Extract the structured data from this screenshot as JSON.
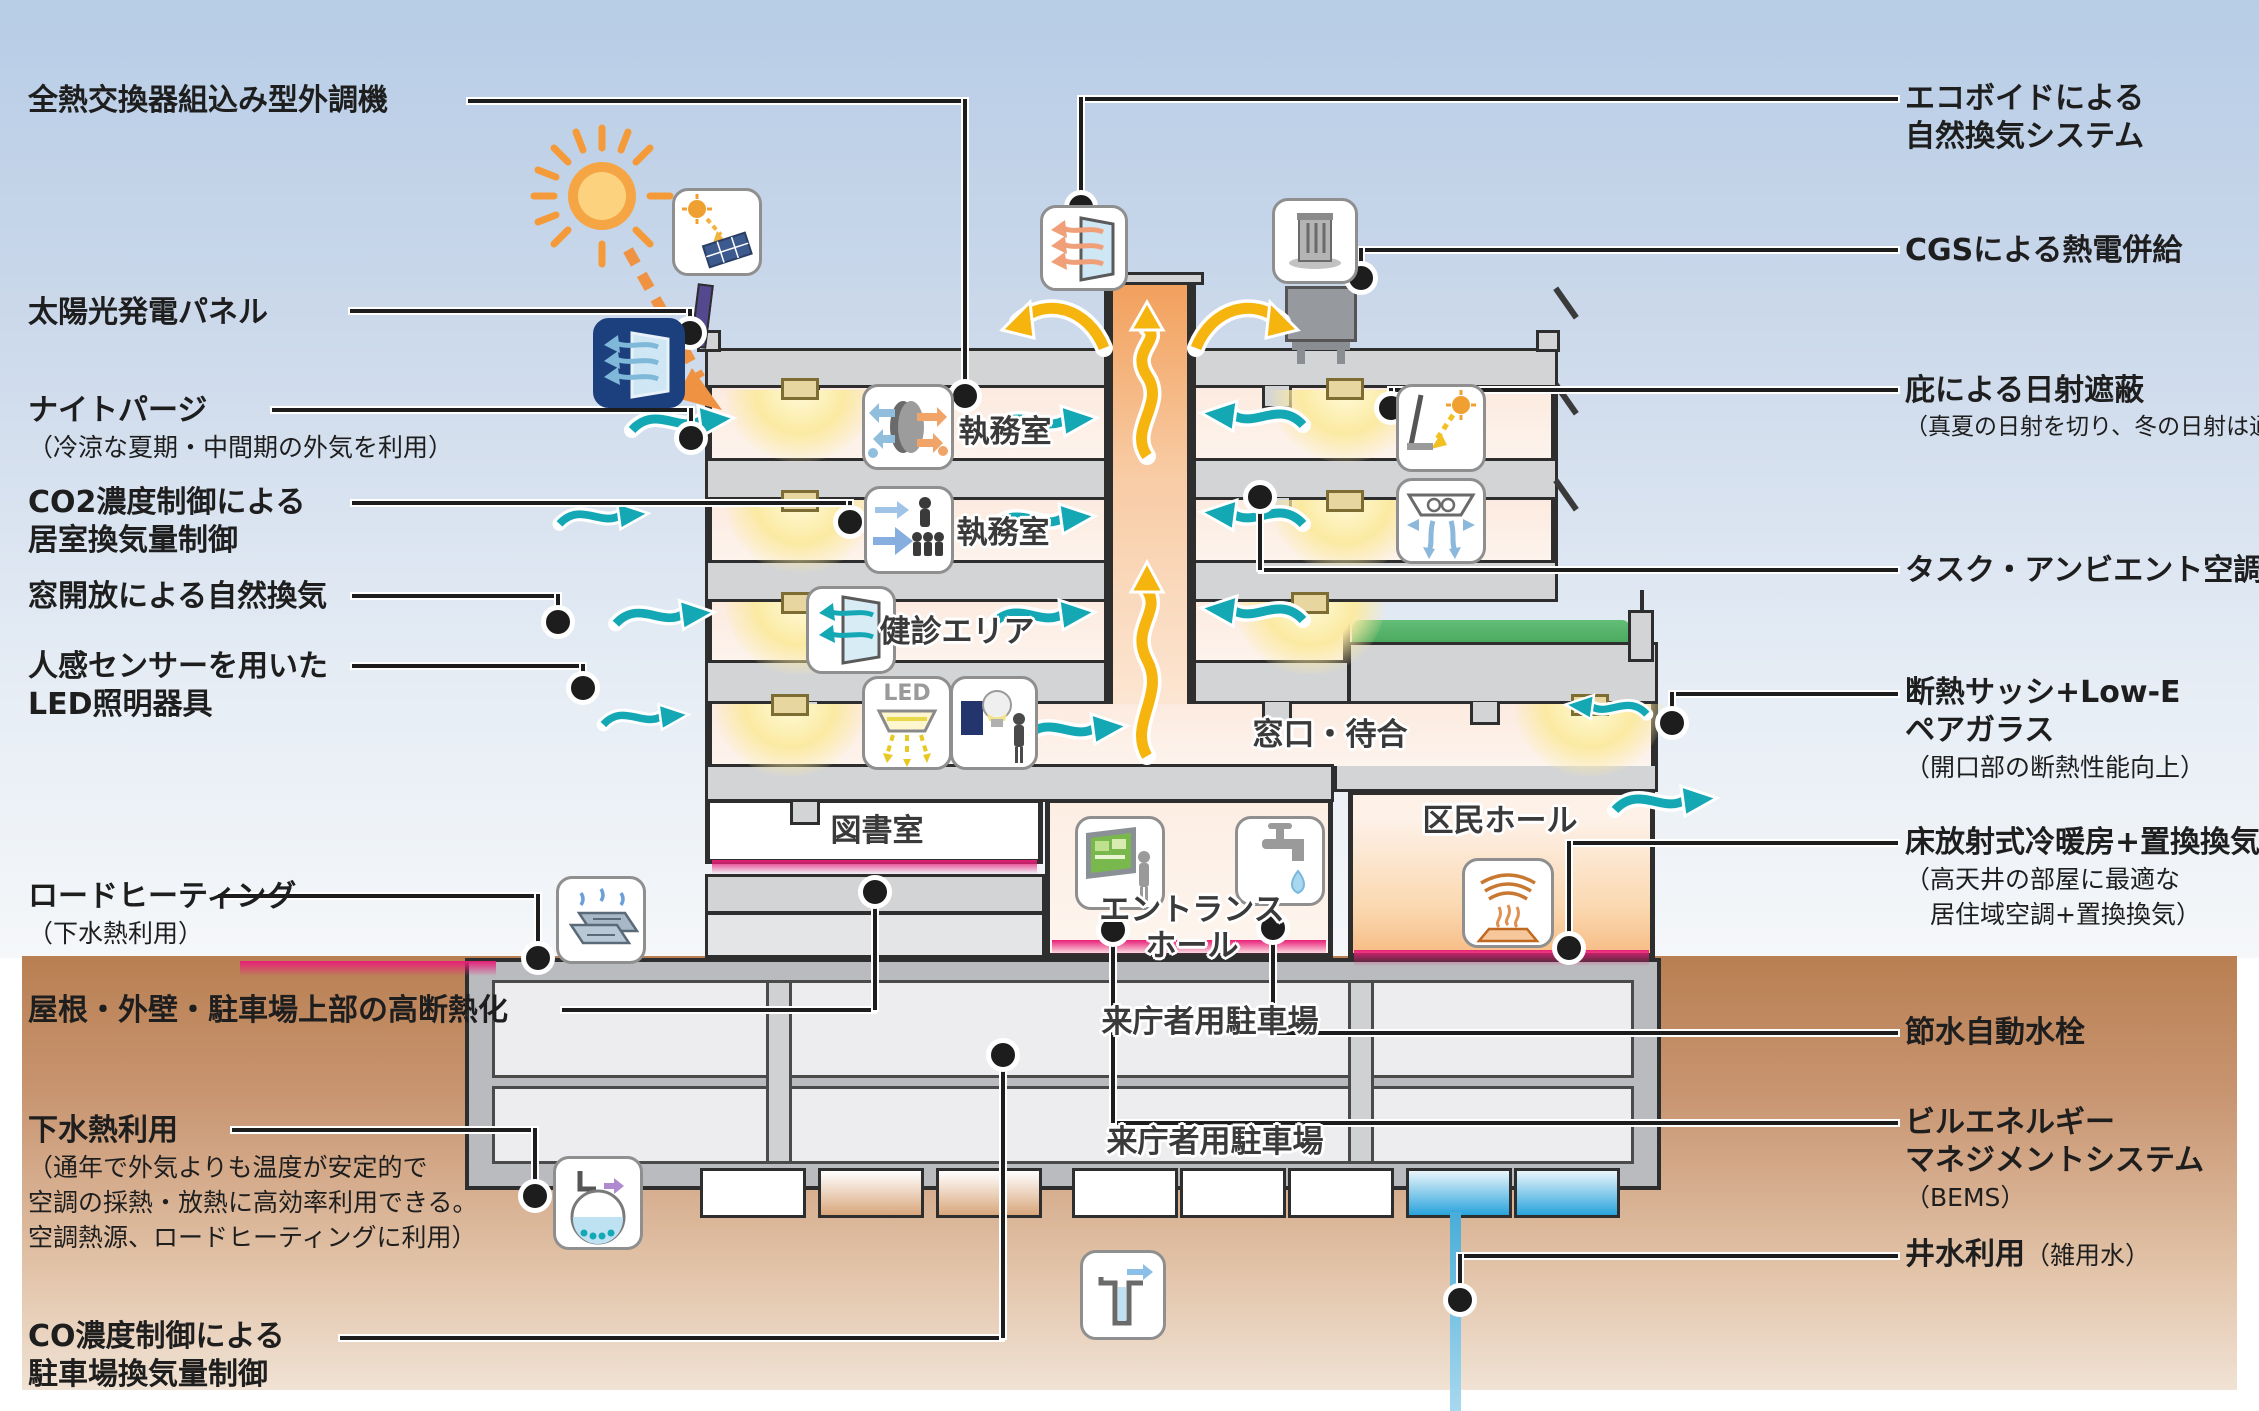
{
  "diagram_title": "庁舎の環境・省エネルギー計画 断面図",
  "labels": {
    "left": [
      {
        "t1": "全熱交換器組込み型外調機"
      },
      {
        "t1": "太陽光発電パネル"
      },
      {
        "t1": "ナイトパージ",
        "s1": "（冷涼な夏期・中間期の外気を利用）"
      },
      {
        "t1": "CO2濃度制御による",
        "t2": "居室換気量制御"
      },
      {
        "t1": "窓開放による自然換気"
      },
      {
        "t1": "人感センサーを用いた",
        "t2": "LED照明器具"
      },
      {
        "t1": "ロードヒーティング",
        "s1": "（下水熱利用）"
      },
      {
        "t1": "屋根・外壁・駐車場上部の高断熱化"
      },
      {
        "t1": "下水熱利用",
        "s1": "（通年で外気よりも温度が安定的で",
        "s2": "空調の採熱・放熱に高効率利用できる。",
        "s3": "空調熱源、ロードヒーティングに利用）"
      },
      {
        "t1": "CO濃度制御による",
        "t2": "駐車場換気量制御"
      }
    ],
    "right": [
      {
        "t1": "エコボイドによる",
        "t2": "自然換気システム"
      },
      {
        "t1": "CGSによる熱電併給"
      },
      {
        "t1": "庇による日射遮蔽",
        "s1": "（真夏の日射を切り、冬の日射は通す）"
      },
      {
        "t1": "タスク・アンビエント空調"
      },
      {
        "t1": "断熱サッシ+Low-E",
        "t2": "ペアガラス",
        "s1": "（開口部の断熱性能向上）"
      },
      {
        "t1": "床放射式冷暖房+置換換気",
        "s1": "（高天井の部屋に最適な",
        "s2": "　居住域空調+置換換気）"
      },
      {
        "t1": "節水自動水栓"
      },
      {
        "t1": "ビルエネルギー",
        "t2": "マネジメントシステム",
        "s1": "（BEMS）"
      },
      {
        "t1": "井水利用",
        "s1": "（雑用水）"
      }
    ]
  },
  "rooms": {
    "office5": "執務室",
    "office4": "執務室",
    "checkup": "健診エリア",
    "service": "窓口・待合",
    "library": "図書室",
    "entrance_l1": "エントランス",
    "entrance_l2": "ホール",
    "hall": "区民ホール",
    "parking_b1": "来庁者用駐車場",
    "parking_b2": "来庁者用駐車場"
  },
  "icons": {
    "led_text": "LED",
    "names": [
      "sun-icon",
      "solar-panel-icon",
      "night-purge-icon",
      "heat-exchanger-icon",
      "co2-control-icon",
      "window-ventilation-icon",
      "led-icon",
      "motion-sensor-icon",
      "ecovoid-window-icon",
      "cgs-icon",
      "sun-shade-icon",
      "task-ambient-icon",
      "road-heating-icon",
      "bems-icon",
      "faucet-icon",
      "floor-radiant-icon",
      "sewage-heat-icon",
      "well-icon"
    ]
  },
  "colors": {
    "teal_arrow": "#14a8b5",
    "yellow_arrow": "#f6b40e",
    "orange_sun": "#f09a3e",
    "magenta_heat": "#e71f78",
    "navy_icon": "#1c3f7e",
    "sky_top": "#b7cde6",
    "earth": "#c89571",
    "slab_gray": "#d3d4d6",
    "line_black": "#1d1d1d",
    "water_blue": "#2aa3dc",
    "green_roof": "#5db872"
  }
}
